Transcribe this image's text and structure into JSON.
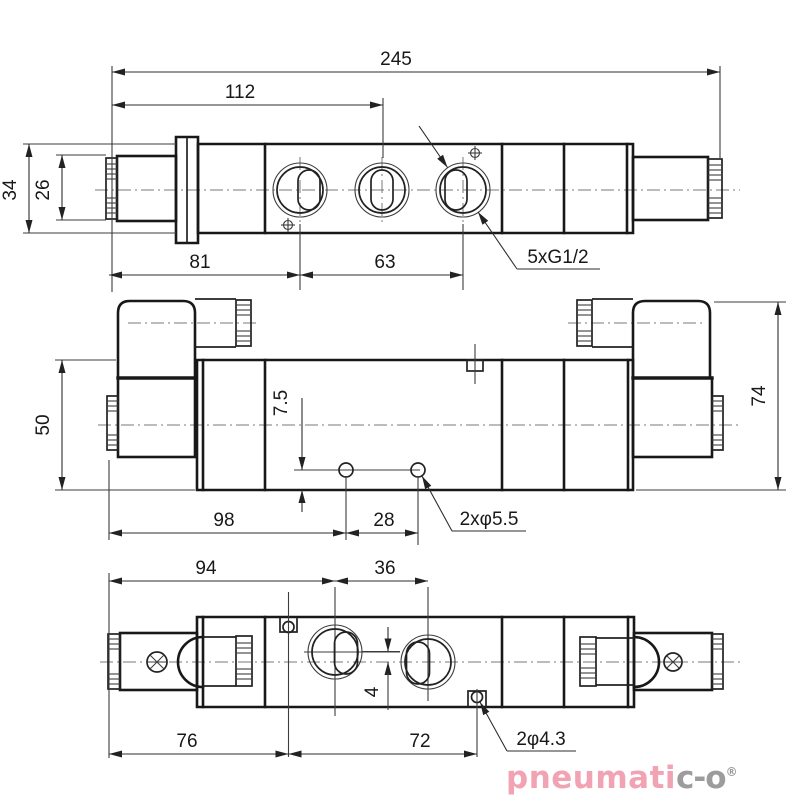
{
  "top_view": {
    "total_length": "245",
    "left_to_middle_port": "112",
    "body_width": "34",
    "solenoid_width": "26",
    "left_to_first_port": "81",
    "first_to_third_port": "63",
    "ports_thread_note": "5xG1/2"
  },
  "front_view": {
    "body_height": "50",
    "total_height": "74",
    "hole_offset_from_bottom": "7.5",
    "left_to_first_hole": "98",
    "hole_spacing": "28",
    "holes_note": "2xφ5.5"
  },
  "bottom_view": {
    "left_to_first_port": "94",
    "port_spacing": "36",
    "port_centerline_offset": "4",
    "left_to_first_hole": "76",
    "hole_spacing": "72",
    "holes_note": "2φ4.3"
  },
  "logo": {
    "brand_primary": "pneumati",
    "brand_secondary": "c-o",
    "registered": "®"
  }
}
